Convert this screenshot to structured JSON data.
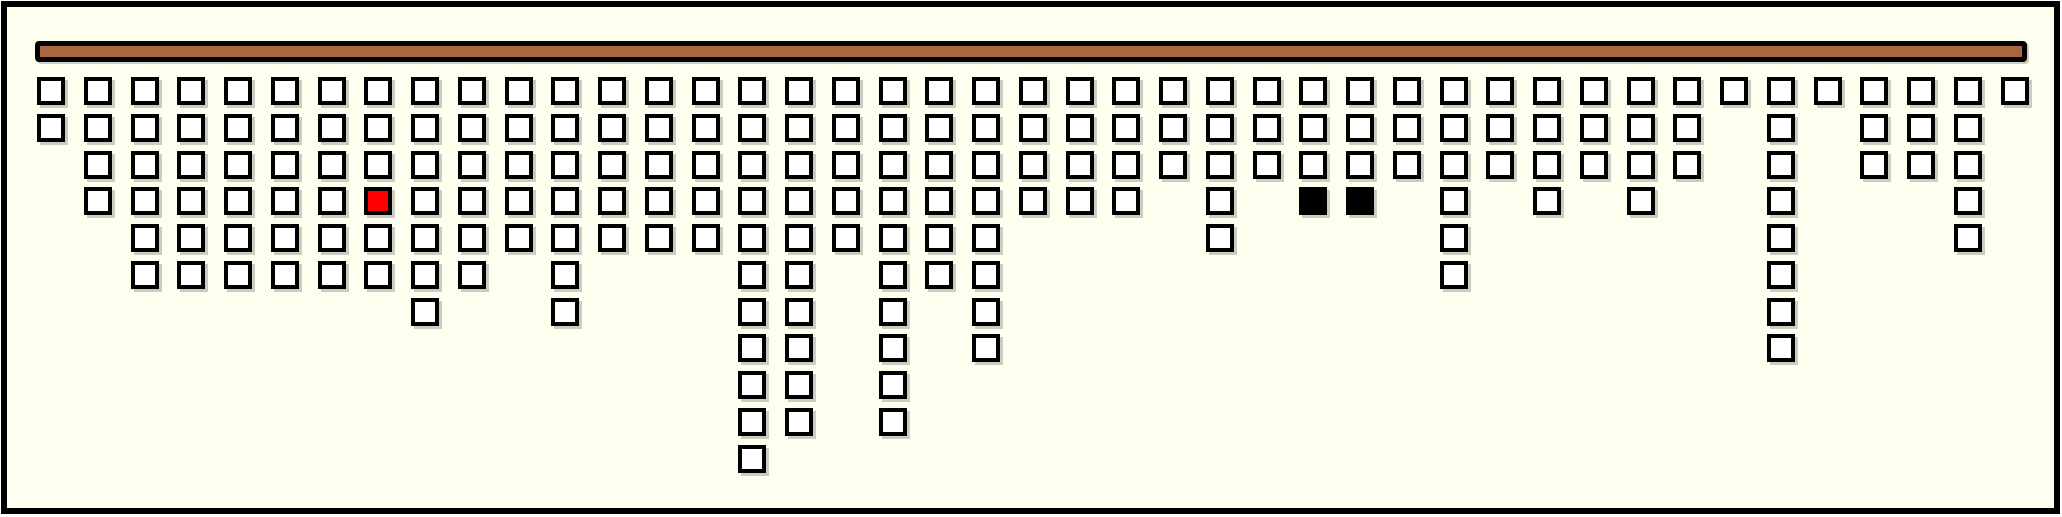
{
  "colors": {
    "page_background": "#ffffff",
    "plot_background": "#fffff0",
    "frame_border": "#000000",
    "bar_fill": "#a9673f",
    "bar_border": "#000000",
    "square_fill": "#ffffff",
    "square_border": "#000000",
    "highlight_red": "#ff0000",
    "highlight_black": "#000000",
    "shadow": "rgba(0,0,0,0.2)"
  },
  "chart_data": {
    "type": "bar",
    "subtype": "unit-square icon-array columns hanging downward from a horizontal bar",
    "orientation": "top-down",
    "column_count": 43,
    "categories": [
      1,
      2,
      3,
      4,
      5,
      6,
      7,
      8,
      9,
      10,
      11,
      12,
      13,
      14,
      15,
      16,
      17,
      18,
      19,
      20,
      21,
      22,
      23,
      24,
      25,
      26,
      27,
      28,
      29,
      30,
      31,
      32,
      33,
      34,
      35,
      36,
      37,
      38,
      39,
      40,
      41,
      42,
      43
    ],
    "values": [
      2,
      4,
      6,
      6,
      6,
      6,
      6,
      6,
      7,
      6,
      5,
      7,
      5,
      5,
      5,
      11,
      10,
      5,
      10,
      6,
      8,
      4,
      4,
      4,
      3,
      5,
      3,
      4,
      4,
      3,
      6,
      3,
      4,
      3,
      4,
      3,
      1,
      8,
      1,
      3,
      3,
      5,
      1
    ],
    "total_units": 211,
    "ylim": [
      0,
      11
    ],
    "grid": "off",
    "legend": "none",
    "highlights": [
      {
        "column": 8,
        "row": 4,
        "color": "#ff0000",
        "style": "red-filled"
      },
      {
        "column": 28,
        "row": 4,
        "color": "#000000",
        "style": "black-filled"
      },
      {
        "column": 29,
        "row": 4,
        "color": "#000000",
        "style": "black-filled"
      }
    ]
  },
  "layout_hints": {
    "first_column_x": 37,
    "column_pitch": 46.75,
    "first_row_y": 77,
    "row_pitch": 36.75,
    "square_size": 28,
    "bar_rect": {
      "x": 35,
      "y": 41,
      "width": 1992,
      "height": 21
    }
  }
}
